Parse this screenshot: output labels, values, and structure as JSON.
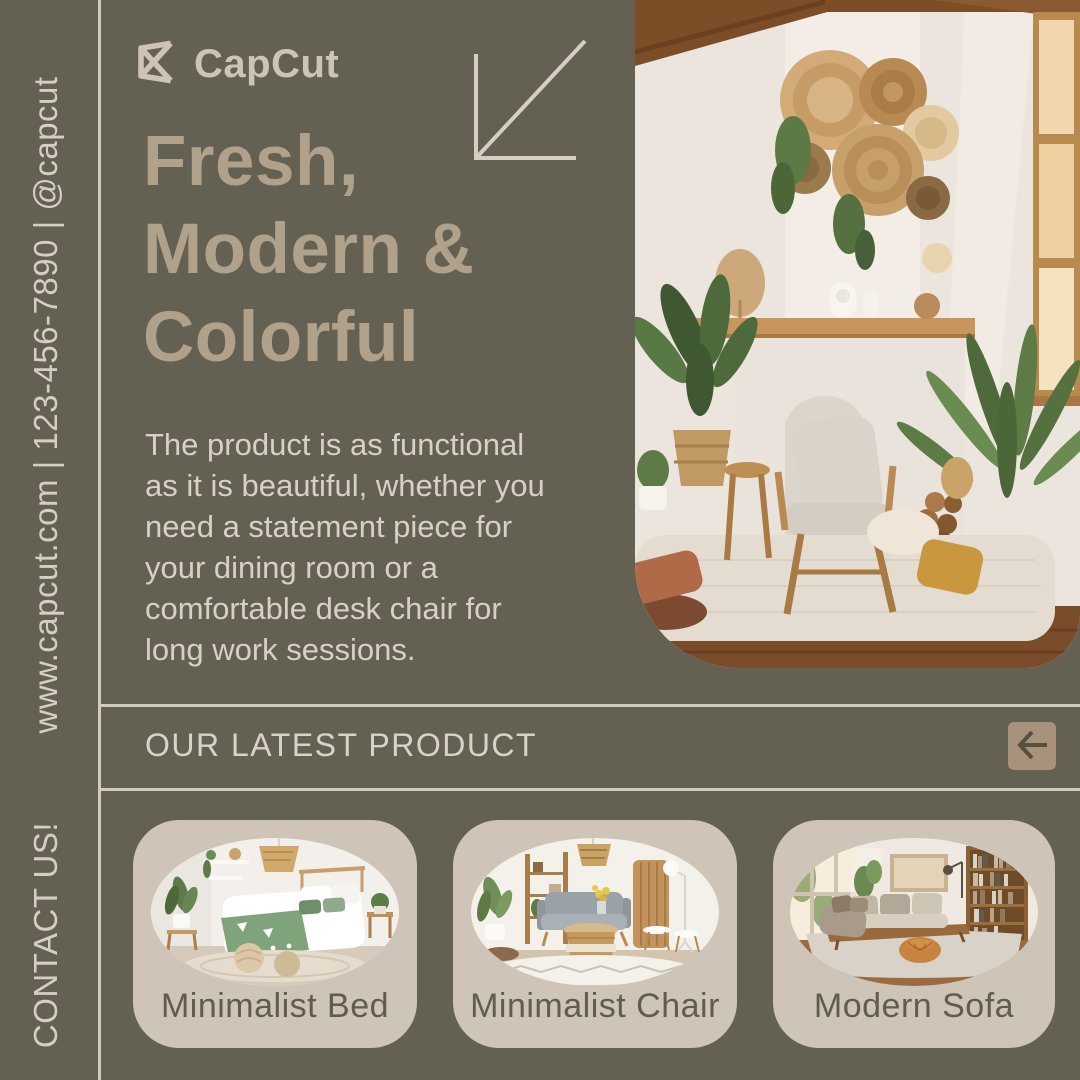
{
  "brand": {
    "name": "CapCut",
    "logo_icon": "capcut-logo"
  },
  "sidebar": {
    "contact_info": "www.capcut.com | 123-456-7890 | @capcut",
    "contact_label": "CONTACT US!"
  },
  "hero": {
    "title_lines": [
      "Fresh,",
      "Modern &",
      "Colorful"
    ],
    "description_lines": [
      "The product is as functional",
      "as it is beautiful, whether you",
      "need a statement piece for",
      "your dining room or a",
      "comfortable desk chair for",
      "long work sessions."
    ],
    "arrow_icon": "arrow-down-left",
    "photo_subject": "boho living room with armchair, plants and wall baskets"
  },
  "products": {
    "section_title": "OUR LATEST PRODUCT",
    "nav_icon": "arrow-left",
    "items": [
      {
        "label": "Minimalist Bed",
        "photo_subject": "bedroom with green and white bedding"
      },
      {
        "label": "Minimalist Chair",
        "photo_subject": "gray sofa with rattan coffee table"
      },
      {
        "label": "Modern Sofa",
        "photo_subject": "sectional sofa with bookshelf and pouf"
      }
    ]
  },
  "colors": {
    "background": "#656152",
    "heading": "#b0a18b",
    "body_text": "#d8d0c5",
    "line": "#d2cbbe",
    "card_background": "#cec5b8",
    "card_label": "#615d4e",
    "nav_button": "#a8927b",
    "nav_arrow": "#545040"
  }
}
